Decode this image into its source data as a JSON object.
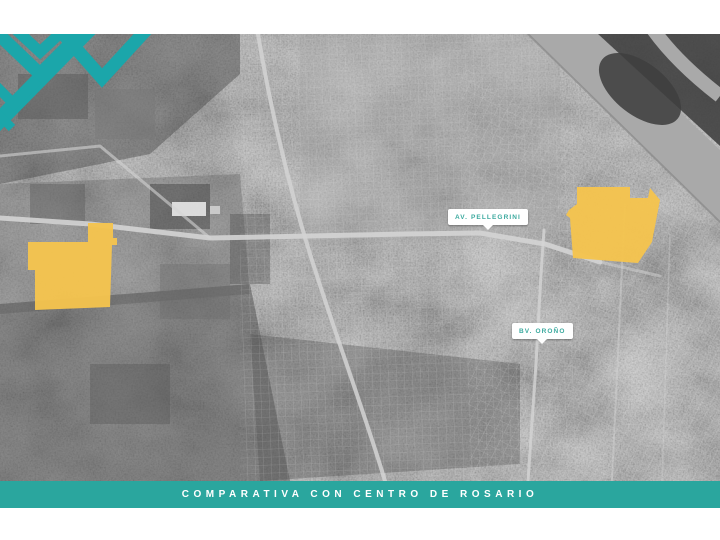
{
  "slide": {
    "caption": "COMPARATIVA CON CENTRO DE ROSARIO"
  },
  "map": {
    "description": "grayscale-satellite-map-of-rosario",
    "street_labels": [
      {
        "text": "AV. PELLEGRINI"
      },
      {
        "text": "BV. OROÑO"
      }
    ],
    "highlights": [
      {
        "name": "parcel-west"
      },
      {
        "name": "parcel-east"
      }
    ]
  },
  "colors": {
    "teal_primary": "#2AA69E",
    "logo_teal": "#1BA6AA",
    "label_text_teal": "#3CAA9F",
    "highlight_yellow": "#F5C44E",
    "map_base_gray": "#8E8E8E",
    "river_gray": "#A9A9A9",
    "island_dark_gray": "#3F3F3F",
    "road_light_gray": "#D4D4D4"
  },
  "icons": {
    "logo": "teal-chevron-logo"
  }
}
